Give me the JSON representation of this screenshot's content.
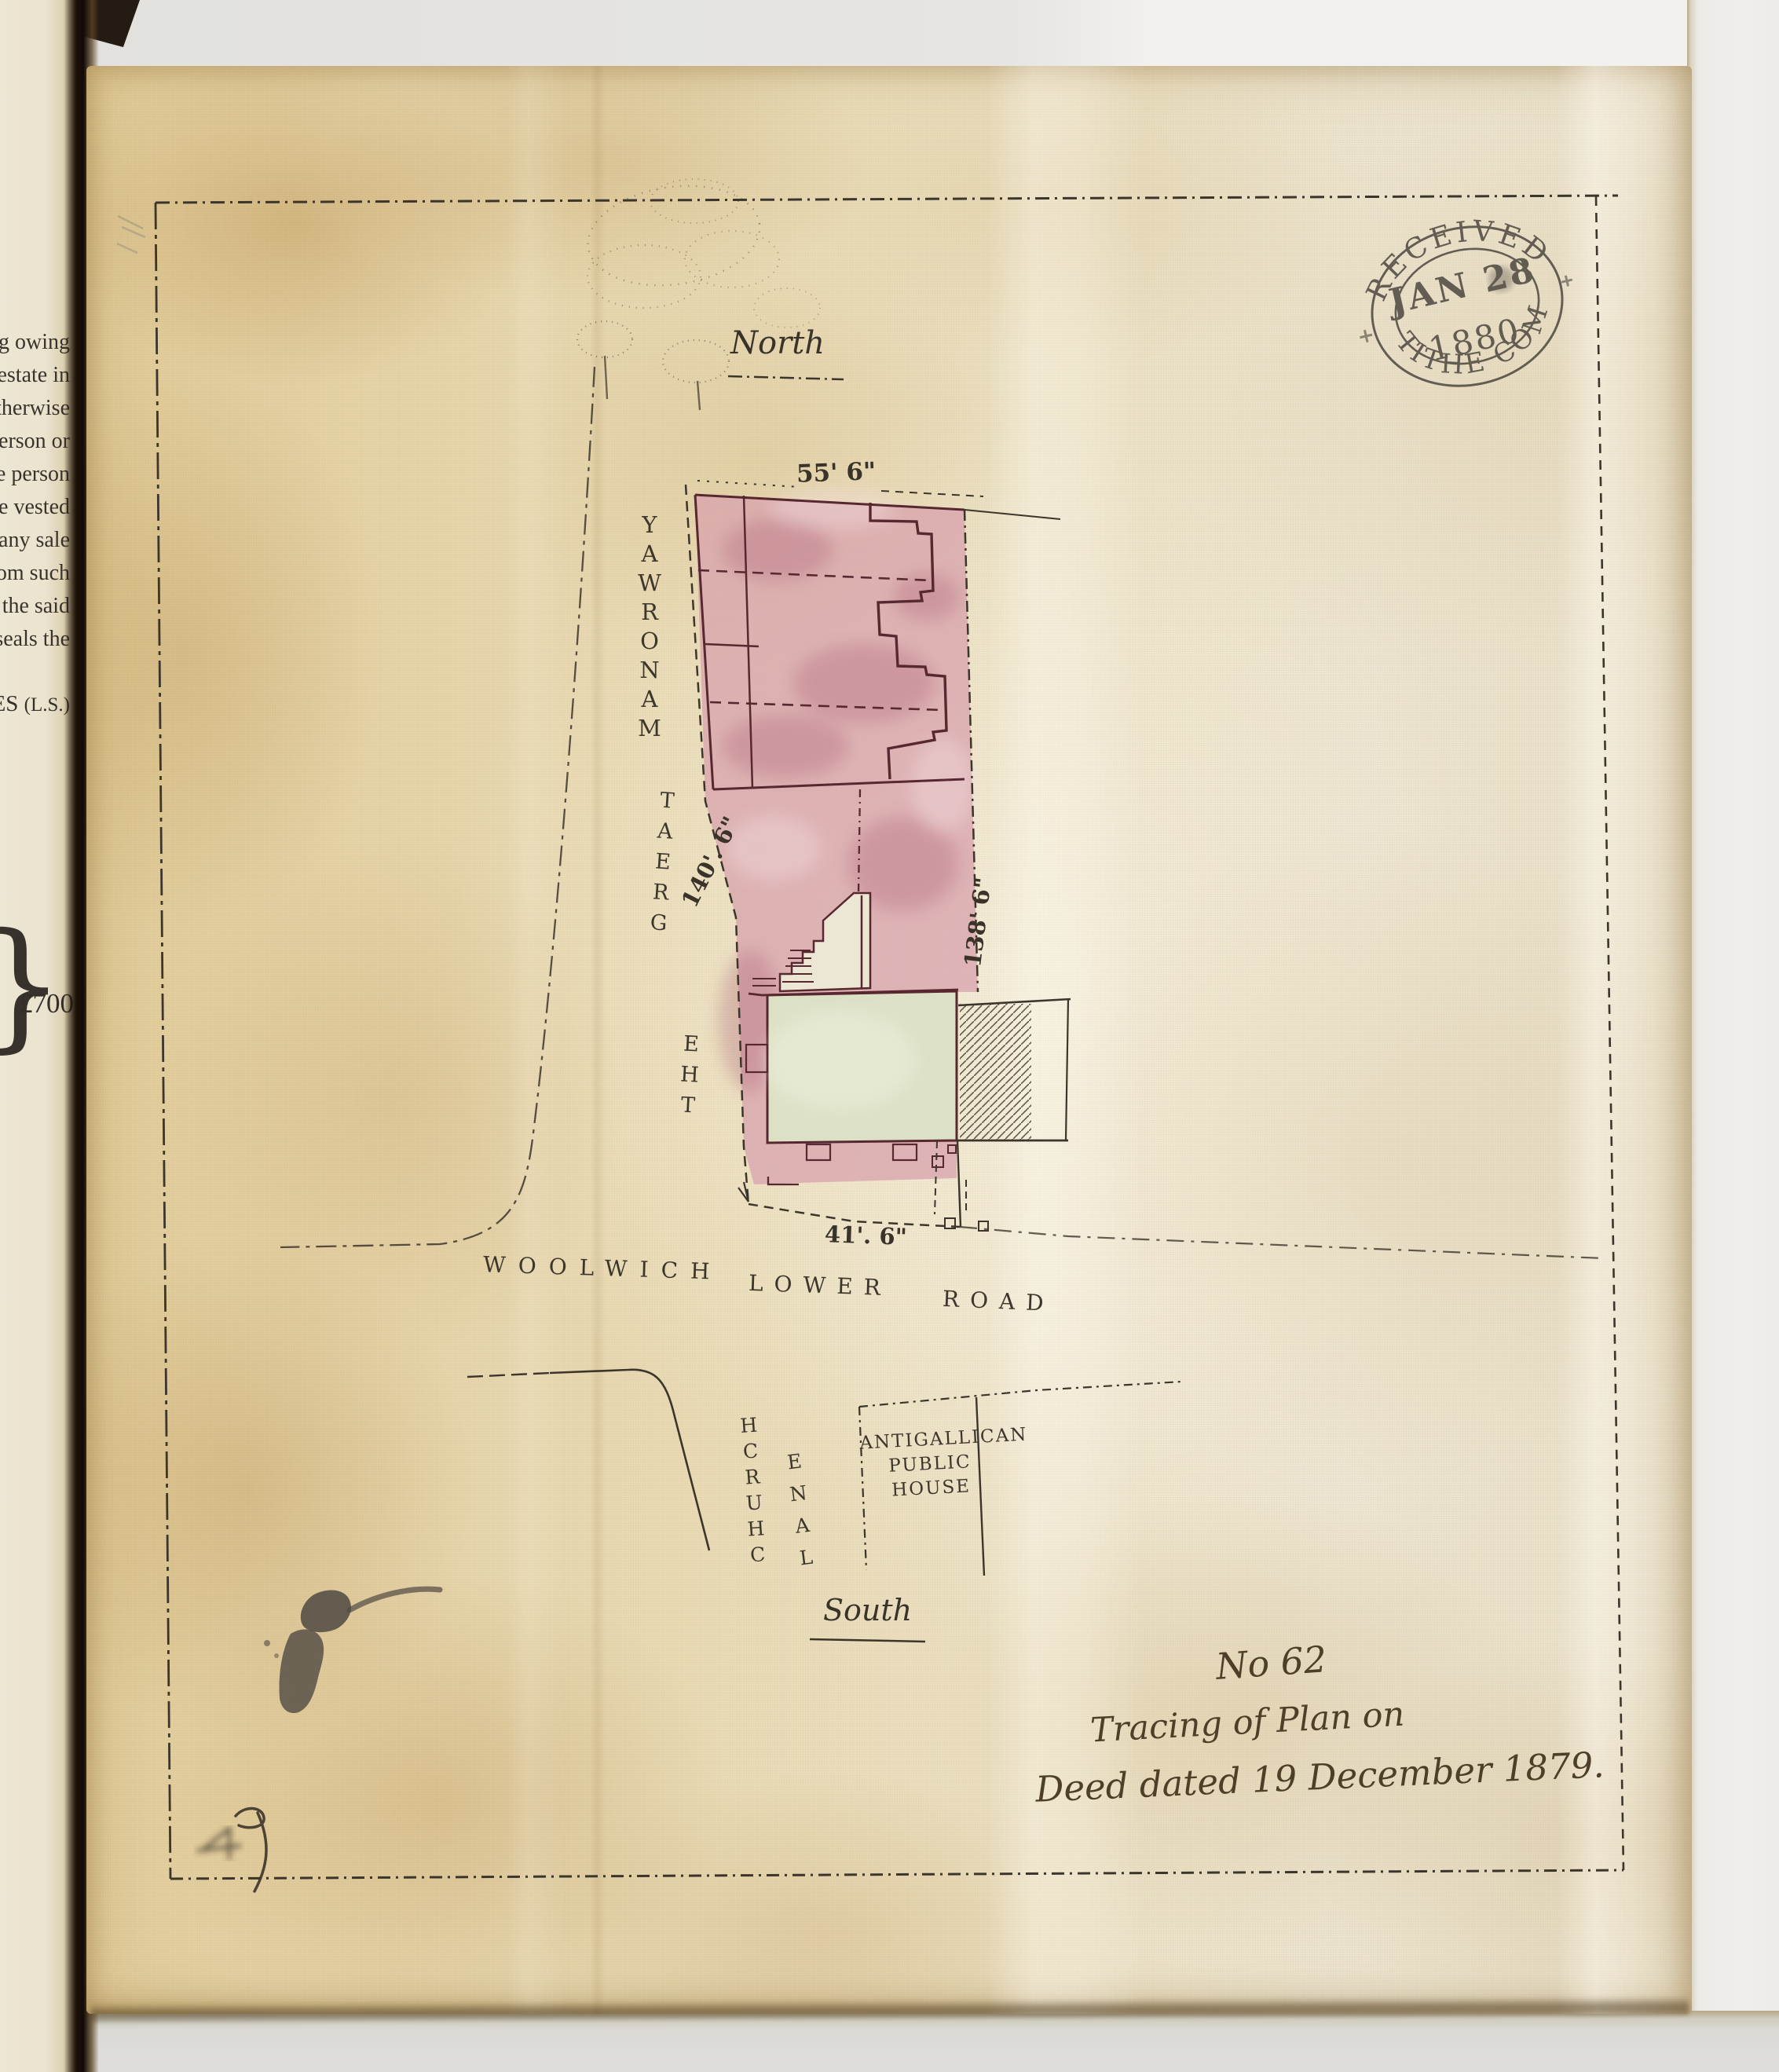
{
  "stamp": {
    "received": "RECEIVED",
    "date": "JAN 28",
    "year": "1880",
    "office": "TITHE COM"
  },
  "compass": {
    "north": "North",
    "south": "South"
  },
  "roads": {
    "the": "THE",
    "great": "GREAT",
    "manorway": "MANORWAY",
    "woolwich": "WOOLWICH",
    "lower": "LOWER",
    "road": "ROAD",
    "church": "CHURCH",
    "lane": "LANE"
  },
  "pub": {
    "line1": "ANTIGALLICAN",
    "line2": "PUBLIC",
    "line3": "HOUSE"
  },
  "measurements": {
    "north_frontage": "55' 6\"",
    "west_side": "140'. 6\"",
    "east_side": "138' 6\"",
    "south_frontage": "41'. 6\""
  },
  "endorsement": {
    "number": "No 62",
    "line2": "Tracing of Plan on",
    "line3": "Deed dated 19 December 1879."
  },
  "left_page": {
    "fragments": [
      "g owing",
      "estate in",
      "therwise",
      "erson or",
      "e person",
      "e vested",
      "any sale",
      "om such",
      "the said",
      "seals the"
    ],
    "signature": "ES",
    "seal": "(L.S.)",
    "brace": "}",
    "amount": "£700."
  },
  "colors": {
    "ink": "#3c352b",
    "plotink": "#57282f",
    "stampink": "#46413a",
    "pink": "#d9a4ad",
    "green": "#dce1c6",
    "building": "#ece7d5"
  }
}
